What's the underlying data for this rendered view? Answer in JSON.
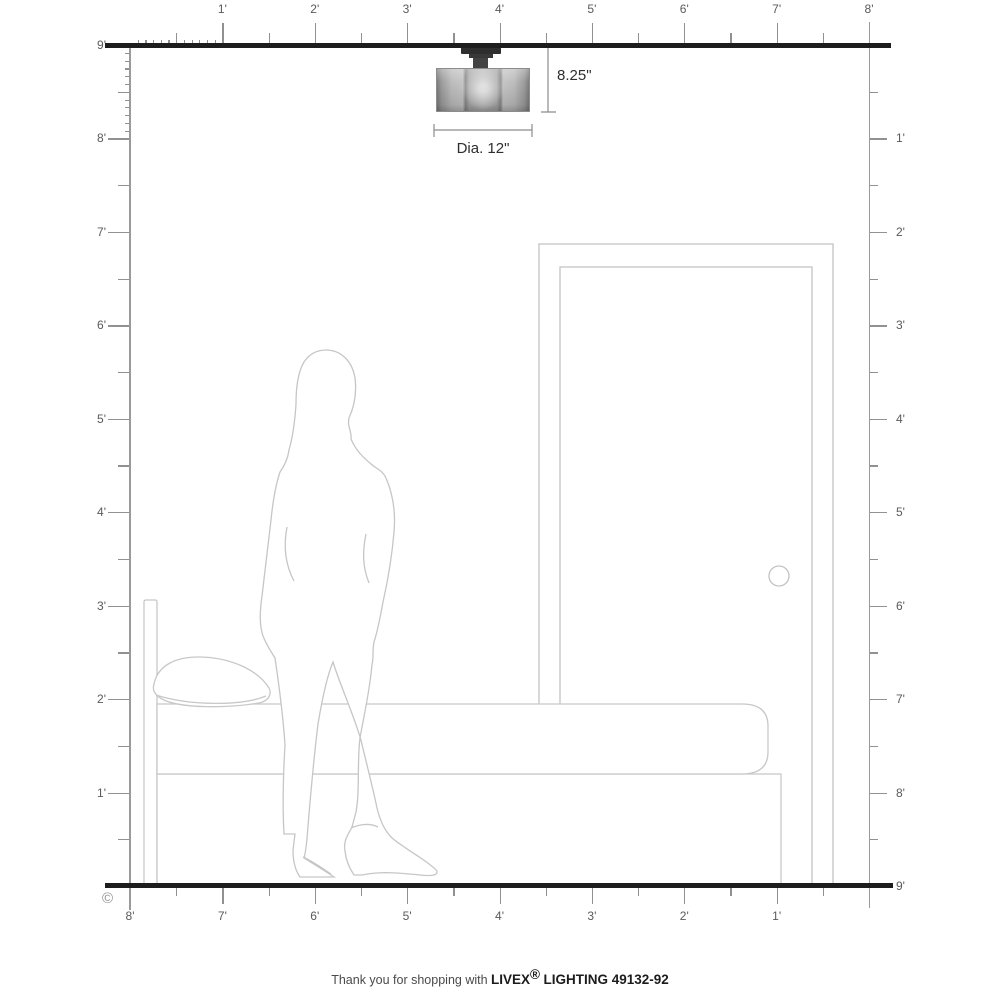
{
  "title": "Livex Lighting fixture room-scale dimension diagram",
  "rulers": {
    "top": {
      "labels": [
        "1'",
        "2'",
        "3'",
        "4'",
        "5'",
        "6'",
        "7'",
        "8'"
      ]
    },
    "bottom": {
      "labels": [
        "8'",
        "7'",
        "6'",
        "5'",
        "4'",
        "3'",
        "2'",
        "1'"
      ]
    },
    "left": {
      "labels": [
        "9'",
        "8'",
        "7'",
        "6'",
        "5'",
        "4'",
        "3'",
        "2'",
        "1'"
      ]
    },
    "right": {
      "labels": [
        "1'",
        "2'",
        "3'",
        "4'",
        "5'",
        "6'",
        "7'",
        "8'",
        "9'"
      ]
    },
    "room_width_feet": 8,
    "room_height_feet": 9
  },
  "fixture": {
    "height_label": "8.25\"",
    "diameter_label": "Dia. 12\""
  },
  "scene_items": [
    "ceiling-light-fixture",
    "woman-silhouette",
    "bed-with-pillow",
    "door-with-knob"
  ],
  "copyright_symbol": "©",
  "footer": {
    "prefix": "Thank you for shopping with",
    "brand": "LIVEX",
    "registered": "®",
    "suffix": "LIGHTING 49132-92"
  },
  "colors": {
    "wall_line": "#1d1d1d",
    "ruler": "#919191",
    "ruler_label": "#5a5a5a",
    "outline": "#c6c6c6",
    "dimension_text": "#2e2e2e"
  }
}
